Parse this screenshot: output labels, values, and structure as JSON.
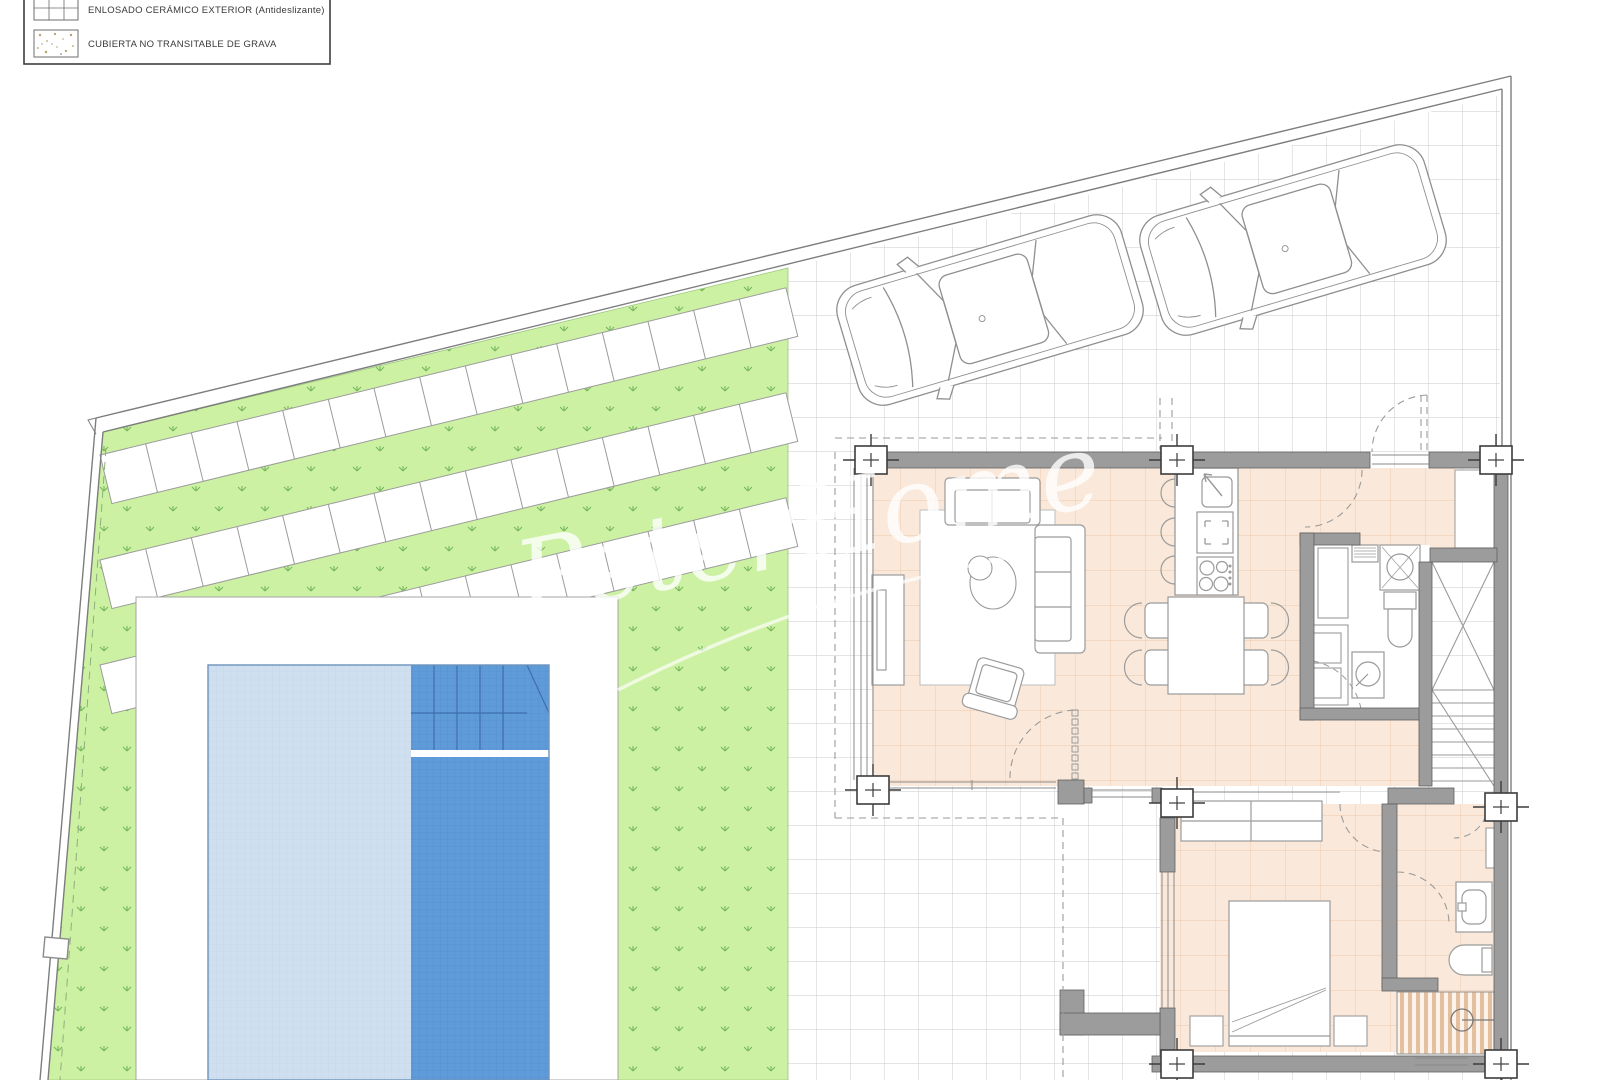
{
  "legend": {
    "items": [
      {
        "id": "ceramic-tile",
        "label": "ENLOSADO CERÁMICO EXTERIOR (Antideslizante)"
      },
      {
        "id": "gravel-roof",
        "label": "CUBIERTA NO TRANSITABLE DE GRAVA"
      }
    ]
  },
  "watermark": {
    "text": "PeterHome"
  },
  "palette": {
    "grass_green": "#ccf1a3",
    "sprig_green": "#76b75c",
    "pool_shallow_blue": "#cfdfef",
    "pool_deep_blue": "#5f9bd9",
    "floor_peach": "#fae9da",
    "floor_grid": "#ecc9a8",
    "wall_gray": "#9c9c9c",
    "patio_grid_gray": "#c9c9c9",
    "shower_stripe_tan": "#e2c0a0",
    "boundary_gray": "#7d7d7d"
  }
}
